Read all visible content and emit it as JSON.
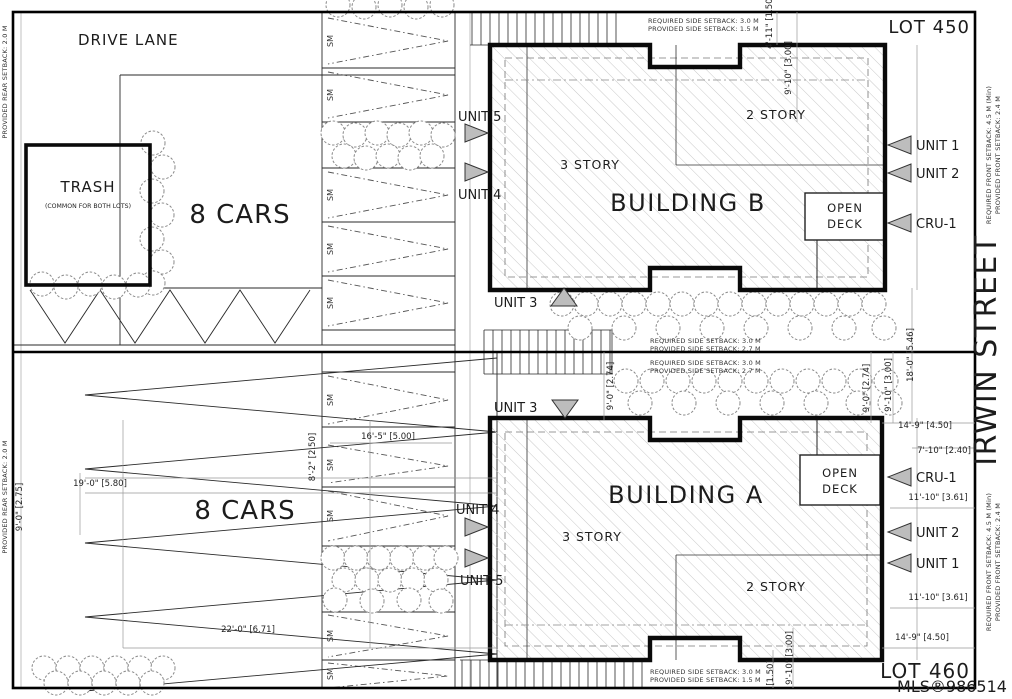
{
  "labels": {
    "drive_lane": "DRIVE LANE",
    "lot_450": "LOT 450",
    "lot_460": "LOT 460",
    "irwin_street": "IRWIN STREET",
    "watermark": "MLS®986514",
    "trash": "TRASH",
    "trash_sub": "(COMMON FOR BOTH LOTS)",
    "cars_top": "8 CARS",
    "cars_bottom": "8 CARS",
    "stall": "SM"
  },
  "building_b": {
    "name": "BUILDING B",
    "story_3": "3 STORY",
    "story_2": "2 STORY",
    "deck_line1": "OPEN",
    "deck_line2": "DECK",
    "unit_1": "UNIT 1",
    "unit_2": "UNIT 2",
    "cru_1": "CRU-1",
    "unit_3": "UNIT 3",
    "unit_4": "UNIT 4",
    "unit_5": "UNIT 5"
  },
  "building_a": {
    "name": "BUILDING A",
    "story_3": "3 STORY",
    "story_2": "2 STORY",
    "deck_line1": "OPEN",
    "deck_line2": "DECK",
    "unit_1": "UNIT 1",
    "unit_2": "UNIT 2",
    "cru_1": "CRU-1",
    "unit_3": "UNIT 3",
    "unit_4": "UNIT 4",
    "unit_5": "UNIT 5"
  },
  "setbacks": {
    "top_required": "REQUIRED SIDE SETBACK: 3.0 M",
    "top_provided": "PROVIDED SIDE SETBACK: 1.5 M",
    "mid_upper_required": "REQUIRED SIDE SETBACK: 3.0 M",
    "mid_upper_provided": "PROVIDED SIDE SETBACK: 2.7 M",
    "mid_lower_required": "REQUIRED SIDE SETBACK: 3.0 M",
    "mid_lower_provided": "PROVIDED SIDE SETBACK: 2.7 M",
    "bottom_required": "REQUIRED SIDE SETBACK: 3.0 M",
    "bottom_provided": "PROVIDED SIDE SETBACK: 1.5 M",
    "front_required": "REQUIRED FRONT SETBACK: 4.5 M (Min)",
    "front_provided": "PROVIDED FRONT SETBACK: 2.4 M",
    "rear_provided": "PROVIDED REAR SETBACK: 2.0 M"
  },
  "dimensions": {
    "top_a": "4'-11\" [1.50]",
    "top_b": "9'-10\" [3.00]",
    "mid_stairs": "9'-0\" [2.74]",
    "right_18_0": "18'-0\" [5.46]",
    "right_9_10": "9'-10\" [3.00]",
    "right_9_0": "9'-0\" [2.74]",
    "right_14_9_top": "14'-9\" [4.50]",
    "right_7_10": "7'-10\" [2.40]",
    "right_11_10_top": "11'-10\" [3.61]",
    "right_11_10_bottom": "11'-10\" [3.61]",
    "right_14_9_bottom": "14'-9\" [4.50]",
    "bottom_a": "[1.50]",
    "bottom_b": "9'-10\" [3.00]",
    "left_9_0": "9'-0\" [2.75]",
    "stall_16_5": "16'-5\" [5.00]",
    "stall_8_2": "8'-2\" [2.50]",
    "park_19_0": "19'-0\" [5.80]",
    "park_22_0": "22'-0\" [6.71]"
  }
}
